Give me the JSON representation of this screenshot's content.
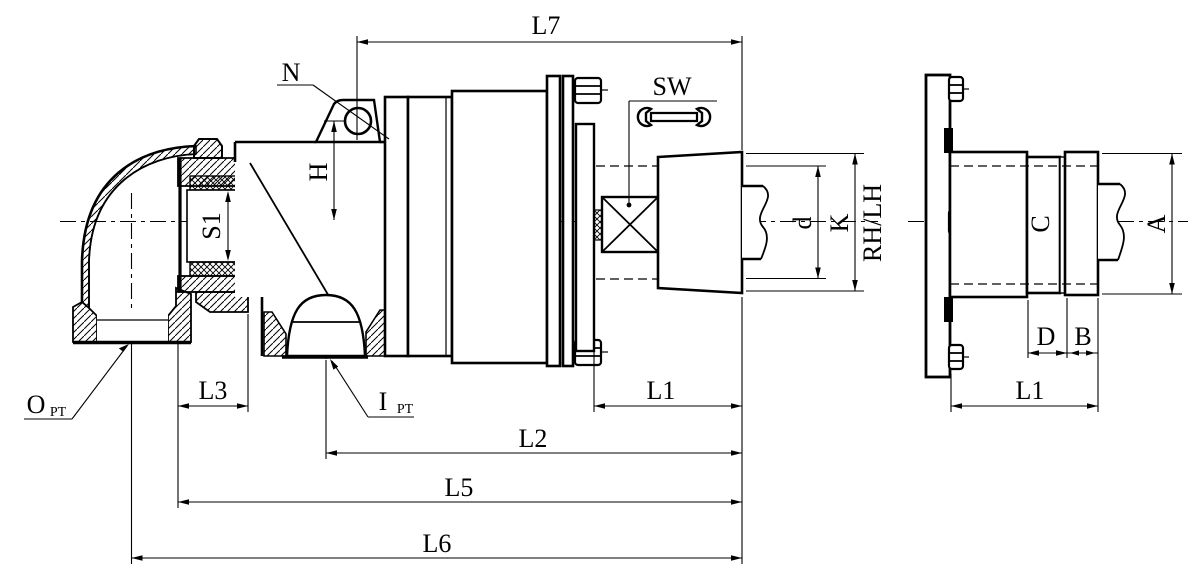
{
  "drawing": {
    "type": "technical-drawing",
    "subject": "rotary joint swivel union - sectional front view and side view",
    "colors": {
      "line": "#000000",
      "background": "#ffffff"
    },
    "front_view": {
      "length_dims": {
        "l7": "L7",
        "l1": "L1",
        "l2": "L2",
        "l3": "L3",
        "l5": "L5",
        "l6": "L6"
      },
      "height_dims": {
        "h": "H",
        "s1": "S1",
        "d": "d",
        "k": "K"
      },
      "thread_direction": "RH/LH",
      "wrench_size": "SW",
      "mount_hole": "N",
      "outlet_port": {
        "symbol": "O",
        "subscript": "PT"
      },
      "inlet_port": {
        "symbol": "I",
        "subscript": "PT"
      }
    },
    "side_view": {
      "length_dims": {
        "l1": "L1",
        "d": "D",
        "b": "B"
      },
      "height_dims": {
        "a": "A",
        "c": "C"
      }
    }
  }
}
